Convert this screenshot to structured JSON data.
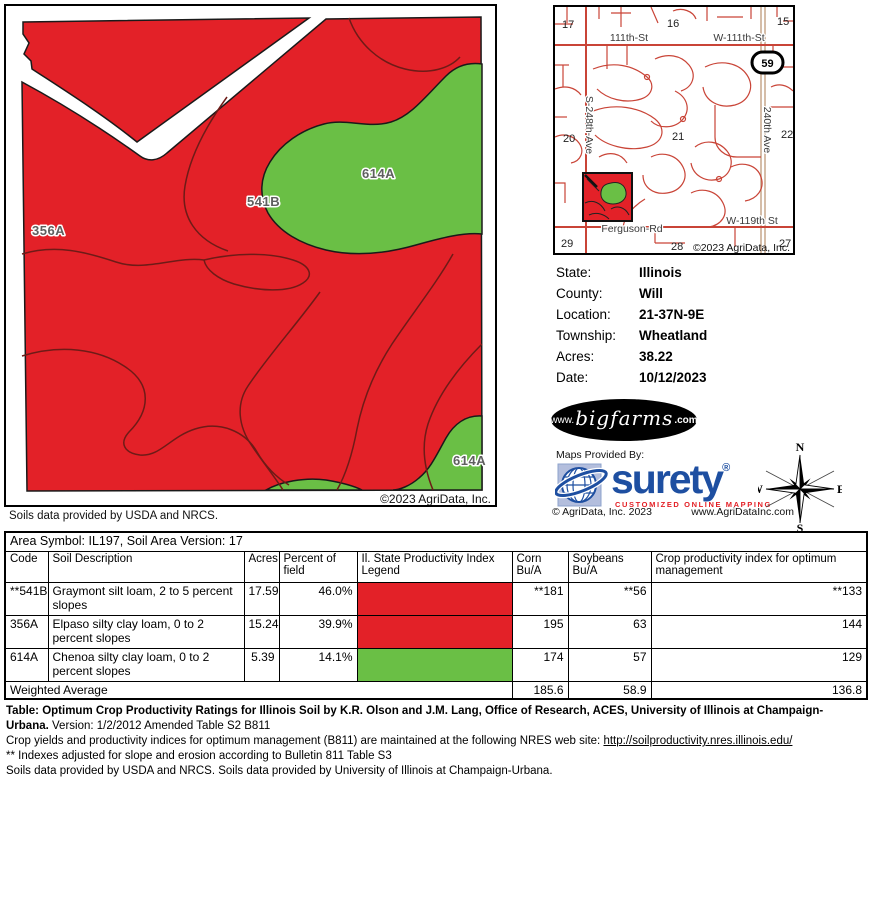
{
  "colors": {
    "map_red": "#e32128",
    "map_green": "#6abf45",
    "contour": "#6e1b17",
    "outline": "#1a1a1a",
    "road_red": "#c94437",
    "road_tan": "#c3a183",
    "surety_blue": "#1e4fa1",
    "surety_red": "#e31e24"
  },
  "main_map": {
    "label_356a": "356A",
    "label_541b": "541B",
    "label_614a_upper": "614A",
    "label_614a_lower": "614A",
    "copyright": "©2023 AgriData, Inc.",
    "soils_note": "Soils data provided by USDA and NRCS."
  },
  "loc_map": {
    "sections": [
      "17",
      "16",
      "15",
      "20",
      "21",
      "22",
      "29",
      "28",
      "27"
    ],
    "streets": {
      "s111": "111th-St",
      "w111": "W-111th-St",
      "s248": "S-248th-Ave",
      "a240": "240th Ave",
      "ferguson": "Ferguson-Rd",
      "w119": "W-119th St"
    },
    "shield": "59",
    "copyright": "©2023 AgriData, Inc."
  },
  "info": {
    "rows": [
      {
        "label": "State:",
        "value": "Illinois"
      },
      {
        "label": "County:",
        "value": "Will"
      },
      {
        "label": "Location:",
        "value": "21-37N-9E"
      },
      {
        "label": "Township:",
        "value": "Wheatland"
      },
      {
        "label": "Acres:",
        "value": "38.22"
      },
      {
        "label": "Date:",
        "value": "10/12/2023"
      }
    ]
  },
  "logos": {
    "bigfarms_www": "www.",
    "bigfarms_name": "bigfarms",
    "bigfarms_com": ".com",
    "maps_provided_by": "Maps Provided By:",
    "surety_name": "surety",
    "surety_reg": "®",
    "surety_tagline": "CUSTOMIZED ONLINE MAPPING",
    "agridata_copyright": "© AgriData, Inc. 2023",
    "agridata_url": "www.AgriDataInc.com"
  },
  "compass": {
    "n": "N",
    "e": "E",
    "s": "S",
    "w": "W"
  },
  "soil_table": {
    "area_line": "Area Symbol: IL197, Soil Area Version: 17",
    "headers": [
      "Code",
      "Soil Description",
      "Acres",
      "Percent of field",
      "Il. State Productivity Index Legend",
      "Corn Bu/A",
      "Soybeans Bu/A",
      "Crop productivity index for optimum management"
    ],
    "rows": [
      {
        "code": "**541B",
        "description": "Graymont silt loam, 2 to 5 percent slopes",
        "acres": "17.59",
        "percent": "46.0%",
        "legend_color": "#e32128",
        "corn": "**181",
        "soybeans": "**56",
        "crop_index": "**133"
      },
      {
        "code": "356A",
        "description": "Elpaso silty clay loam, 0 to 2 percent slopes",
        "acres": "15.24",
        "percent": "39.9%",
        "legend_color": "#e32128",
        "corn": "195",
        "soybeans": "63",
        "crop_index": "144"
      },
      {
        "code": "614A",
        "description": "Chenoa silty clay loam, 0 to 2 percent slopes",
        "acres": "5.39",
        "percent": "14.1%",
        "legend_color": "#6abf45",
        "corn": "174",
        "soybeans": "57",
        "crop_index": "129"
      }
    ],
    "weighted": {
      "label": "Weighted Average",
      "corn": "185.6",
      "soybeans": "58.9",
      "crop_index": "136.8"
    }
  },
  "footnotes": {
    "line1_bold": "Table: Optimum Crop Productivity Ratings for Illinois Soil by K.R. Olson and J.M. Lang, Office of Research, ACES, University of Illinois at Champaign-Urbana.",
    "line1_rest": " Version: 1/2/2012 Amended Table S2 B811",
    "line2_text": "Crop yields and productivity indices for optimum management (B811) are maintained at the following NRES web site: ",
    "line2_link": "http://soilproductivity.nres.illinois.edu/",
    "line3": "** Indexes adjusted for slope and erosion according to Bulletin 811 Table S3",
    "line4": "Soils data provided by USDA and NRCS. Soils data provided by University of Illinois at Champaign-Urbana."
  }
}
